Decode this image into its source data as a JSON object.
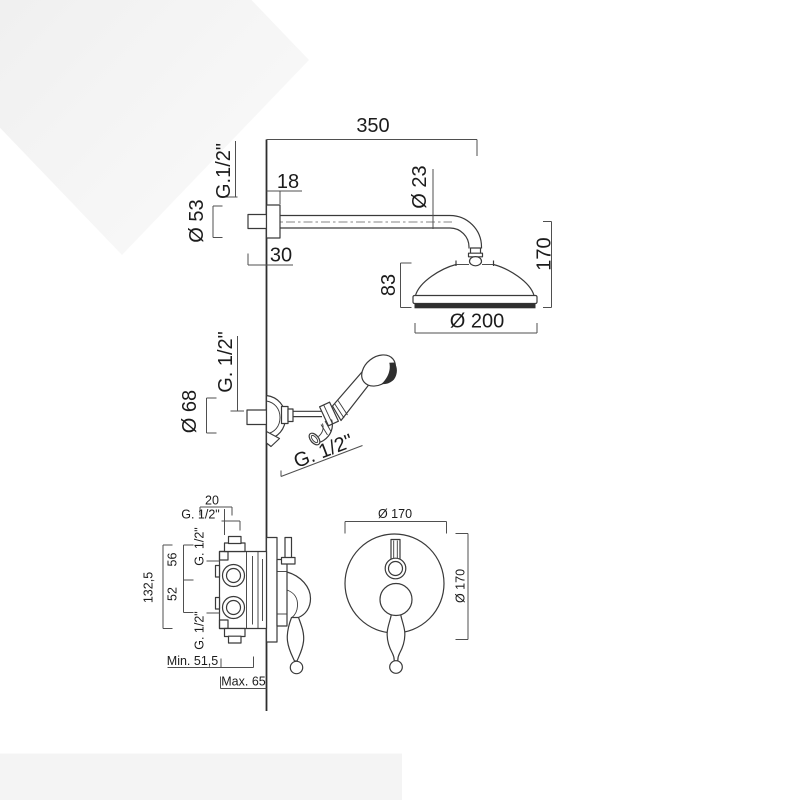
{
  "colors": {
    "dark_fill": "#2f2f2f",
    "diamond_start": "#ececec",
    "diamond_end": "#fbfbfb",
    "band": "#f4f4f4"
  },
  "rain_shower": {
    "dim_arm_length": "350",
    "thread_wall": "G.1/2\"",
    "dia_flange": "Ø 53",
    "dim_flange_depth": "18",
    "dia_arm": "Ø 23",
    "dim_wall_stub": "30",
    "dim_head_height": "83",
    "dim_head_drop": "170",
    "dia_head": "Ø 200"
  },
  "hand_shower": {
    "thread_wall": "G. 1/2\"",
    "dia_holder": "Ø 68",
    "thread_hose": "G. 1/2\""
  },
  "mixer_valve": {
    "dim_top_port": "20",
    "thread_top_port": "G. 1/2\"",
    "thread_upper_port": "G. 1/2\"",
    "dim_upper_spacing": "56",
    "dim_lower_spacing": "52",
    "dim_overall_height": "132,5",
    "thread_lower_port": "G. 1/2\"",
    "dim_recess_min": "Min. 51,5",
    "dim_recess_max": "Max. 65"
  },
  "trim_plate": {
    "dia_width": "Ø 170",
    "dia_height": "Ø 170"
  }
}
